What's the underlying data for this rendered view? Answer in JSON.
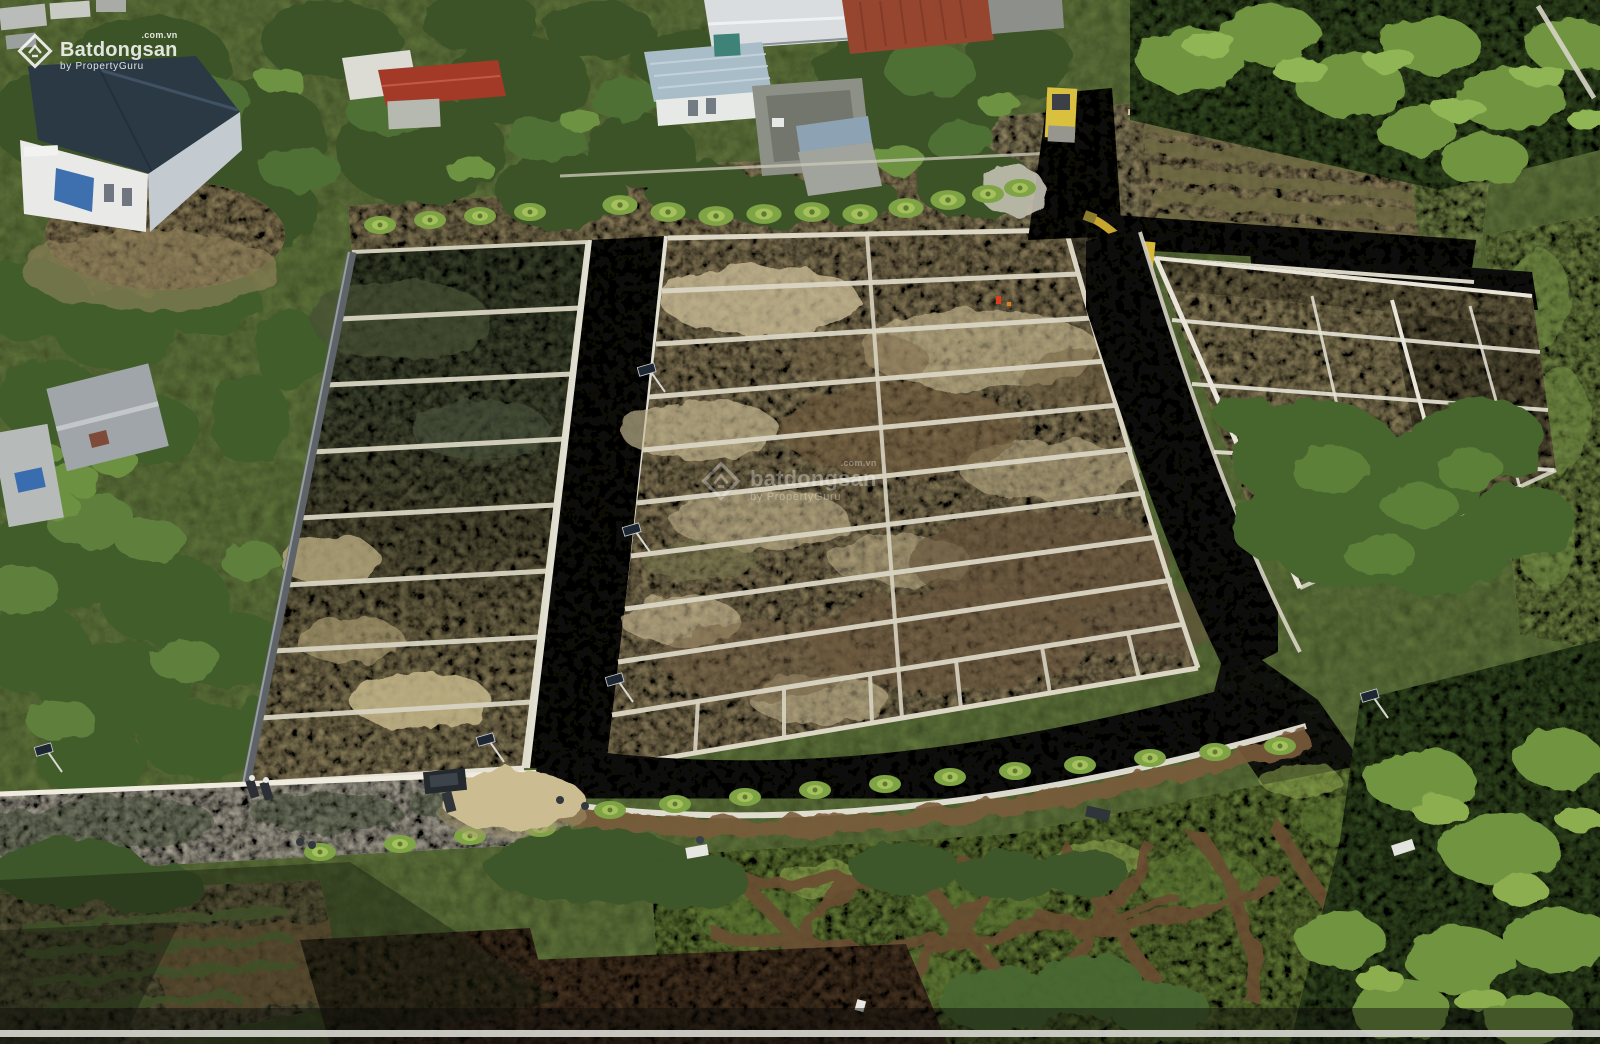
{
  "scene": {
    "description": "Aerial drone photo of a rural land subdivision under construction: grids of dirt plots bordered by white concrete curbs, freshly paved black asphalt roads, a yellow excavator and road roller, surrounding houses, tropical trees, palm saplings and a green paddy field in the foreground"
  },
  "watermark_corner": {
    "brand": "Batdongsan",
    "suffix": ".com.vn",
    "byline": "by PropertyGuru"
  },
  "watermark_center": {
    "brand": "batdongsan",
    "suffix": ".com.vn",
    "byline": "by PropertyGuru"
  },
  "video_overlay": {
    "progress_percent": 100
  },
  "colors": {
    "asphalt": "#1a1a17",
    "plot_soil": "#ab9a70",
    "wet_soil": "#565f40",
    "curb_white": "#dbd6c4",
    "vegetation": "#55703a",
    "paddy_green": "#7e9a46",
    "machine_yellow": "#d8b83a",
    "roof_navy": "#2b3945",
    "watermark_white": "#ffffff"
  }
}
